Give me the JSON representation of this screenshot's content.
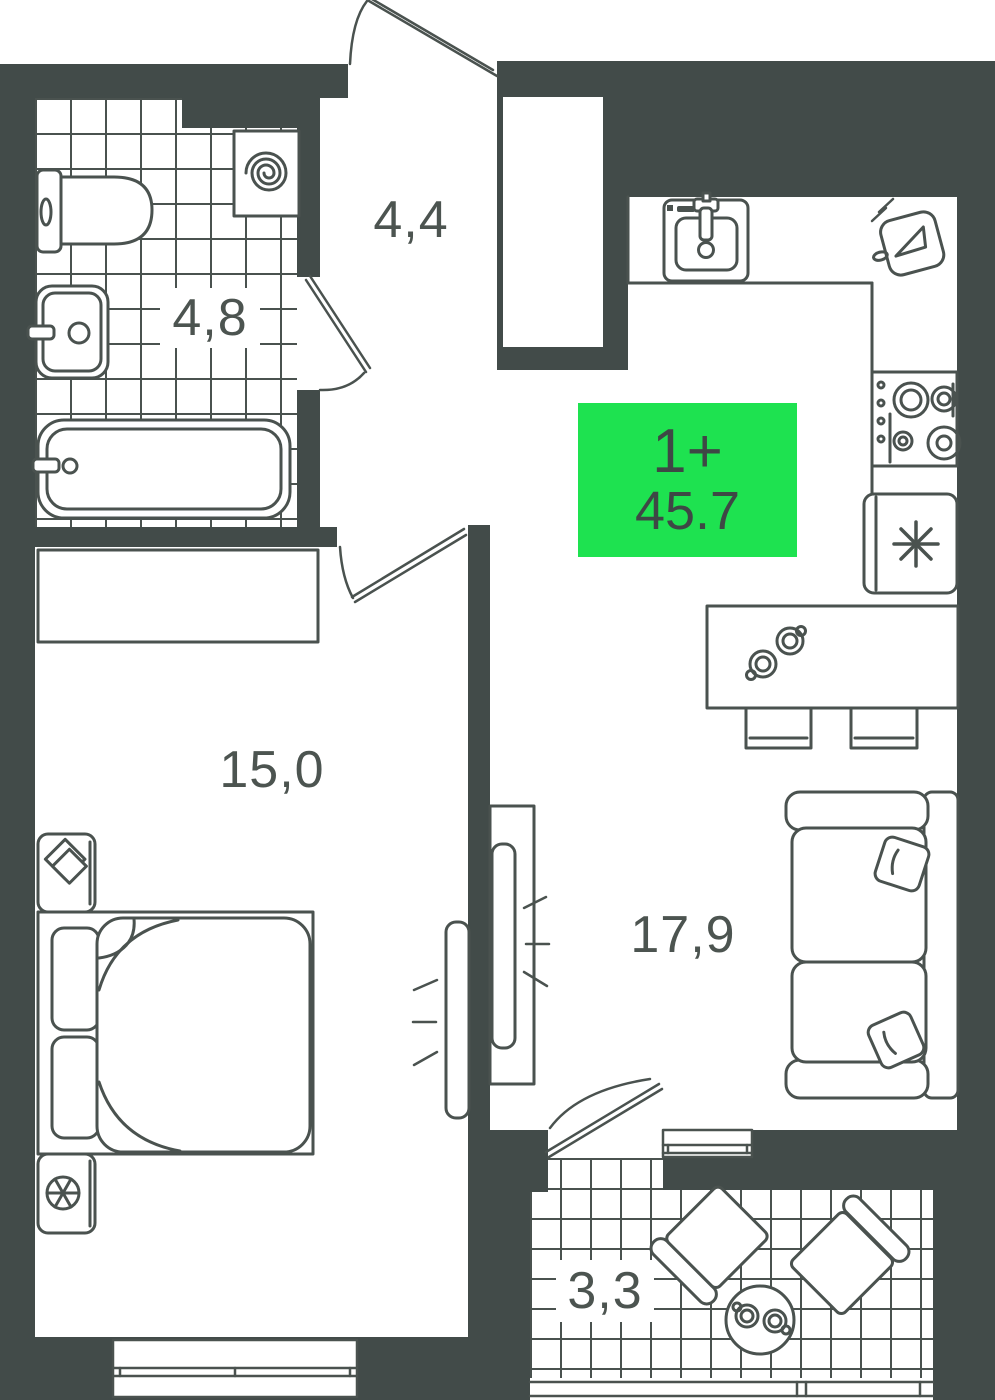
{
  "title": "Apartment floor plan",
  "badge": {
    "rooms_label": "1+",
    "area_value": "45.7",
    "background": "#1EE250",
    "text_color": "#3E4745"
  },
  "rooms": {
    "hallway": {
      "area": "4,4"
    },
    "bathroom": {
      "area": "4,8"
    },
    "bedroom": {
      "area": "15,0"
    },
    "living_kitchen": {
      "area": "17,9"
    },
    "balcony": {
      "area": "3,3"
    }
  },
  "colors": {
    "wall": "#424B49",
    "line": "#4A524F",
    "label_text": "#4C5450"
  },
  "fixtures": [
    "toilet",
    "washing-machine",
    "bathroom-sink",
    "bathtub",
    "wardrobe",
    "bed",
    "nightstand",
    "lamp",
    "plant",
    "tv",
    "tv-stand",
    "kitchen-sink",
    "cutting-board",
    "stove",
    "fridge",
    "bar-table",
    "stool",
    "sofa",
    "pillow",
    "armchair",
    "round-table",
    "cup",
    "door-swing",
    "window",
    "balcony-railing"
  ]
}
